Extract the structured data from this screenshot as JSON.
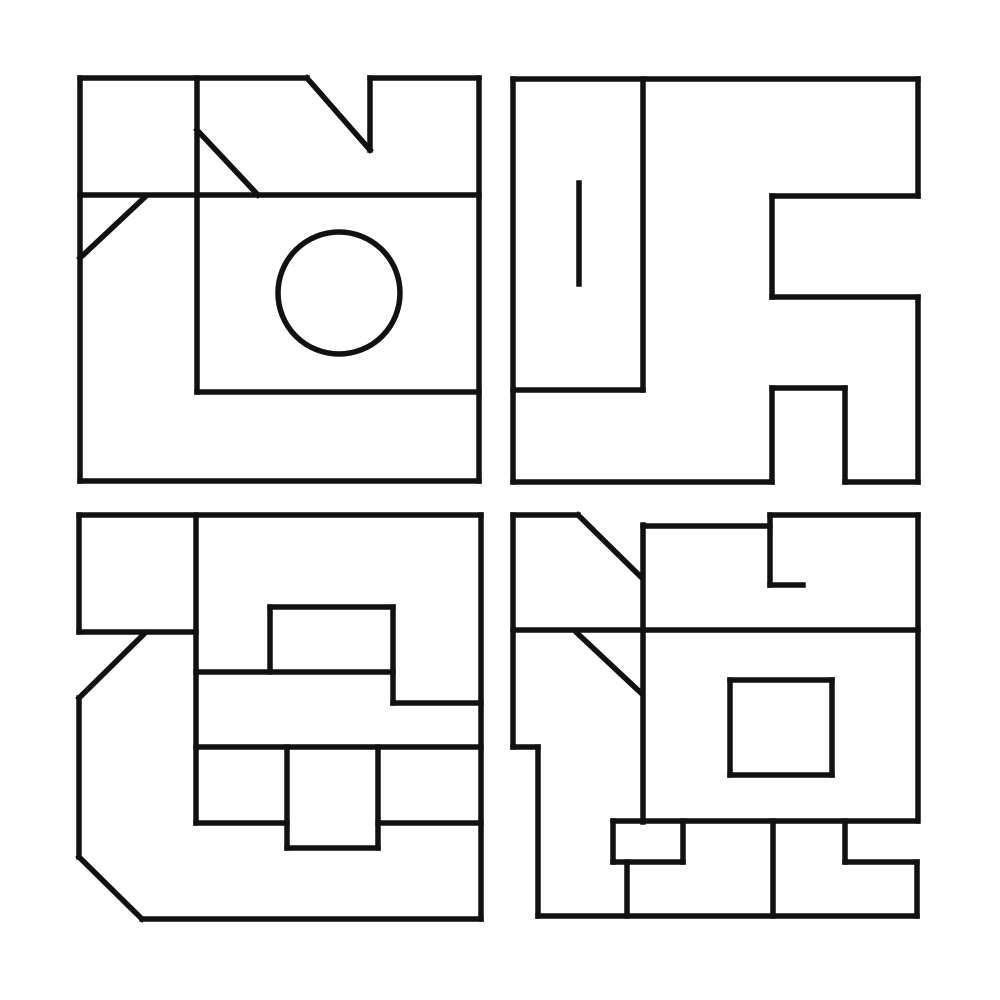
{
  "canvas": {
    "width": 1000,
    "height": 1000,
    "background_color": "#ffffff",
    "stroke_color": "#111111",
    "stroke_width": 5.5,
    "grid": "2x2 panels of abstract black line-art glyphs"
  },
  "panels": [
    {
      "name": "top-left-glyph",
      "bounds": [
        80,
        78,
        479,
        481
      ],
      "segments": [
        [
          80,
          78,
          307,
          78
        ],
        [
          370,
          78,
          479,
          78
        ],
        [
          479,
          78,
          479,
          481
        ],
        [
          80,
          481,
          479,
          481
        ],
        [
          80,
          78,
          80,
          481
        ],
        [
          307,
          78,
          370,
          150
        ],
        [
          370,
          78,
          370,
          150
        ],
        [
          197,
          78,
          197,
          392
        ],
        [
          80,
          195,
          479,
          195
        ],
        [
          197,
          130,
          258,
          195
        ],
        [
          145,
          197,
          80,
          258
        ],
        [
          197,
          392,
          479,
          392
        ]
      ],
      "circles": [
        {
          "cx": 339,
          "cy": 293,
          "r": 61
        }
      ]
    },
    {
      "name": "top-right-glyph",
      "bounds": [
        513,
        79,
        918,
        482
      ],
      "segments": [
        [
          513,
          79,
          918,
          79
        ],
        [
          513,
          79,
          513,
          482
        ],
        [
          513,
          482,
          772,
          482
        ],
        [
          845,
          482,
          918,
          482
        ],
        [
          918,
          79,
          918,
          196
        ],
        [
          918,
          297,
          918,
          482
        ],
        [
          772,
          196,
          918,
          196
        ],
        [
          772,
          196,
          772,
          297
        ],
        [
          772,
          297,
          918,
          297
        ],
        [
          772,
          388,
          772,
          482
        ],
        [
          772,
          388,
          845,
          388
        ],
        [
          845,
          388,
          845,
          482
        ],
        [
          643,
          79,
          643,
          390
        ],
        [
          513,
          390,
          643,
          390
        ],
        [
          579,
          183,
          579,
          284
        ]
      ],
      "circles": []
    },
    {
      "name": "bottom-left-glyph",
      "bounds": [
        79,
        515,
        481,
        919
      ],
      "segments": [
        [
          79,
          515,
          481,
          515
        ],
        [
          481,
          515,
          481,
          919
        ],
        [
          142,
          919,
          481,
          919
        ],
        [
          79,
          857,
          142,
          919
        ],
        [
          79,
          698,
          79,
          857
        ],
        [
          145,
          633,
          79,
          698
        ],
        [
          79,
          515,
          79,
          632
        ],
        [
          79,
          632,
          196,
          632
        ],
        [
          196,
          515,
          196,
          823
        ],
        [
          196,
          672,
          393,
          672
        ],
        [
          270,
          607,
          393,
          607
        ],
        [
          270,
          607,
          270,
          672
        ],
        [
          393,
          607,
          393,
          703
        ],
        [
          393,
          703,
          481,
          703
        ],
        [
          196,
          747,
          481,
          747
        ],
        [
          196,
          823,
          287,
          823
        ],
        [
          378,
          823,
          481,
          823
        ],
        [
          287,
          747,
          287,
          848
        ],
        [
          378,
          747,
          378,
          848
        ],
        [
          287,
          848,
          378,
          848
        ]
      ],
      "circles": []
    },
    {
      "name": "bottom-right-glyph",
      "bounds": [
        513,
        515,
        918,
        916
      ],
      "segments": [
        [
          513,
          515,
          578,
          515
        ],
        [
          578,
          515,
          641,
          577
        ],
        [
          643,
          525,
          643,
          822
        ],
        [
          643,
          526,
          770,
          526
        ],
        [
          770,
          515,
          770,
          585
        ],
        [
          770,
          585,
          803,
          585
        ],
        [
          770,
          515,
          918,
          515
        ],
        [
          918,
          515,
          918,
          821
        ],
        [
          513,
          630,
          918,
          630
        ],
        [
          577,
          633,
          641,
          693
        ],
        [
          513,
          515,
          513,
          747
        ],
        [
          513,
          747,
          538,
          747
        ],
        [
          538,
          747,
          538,
          916
        ],
        [
          538,
          916,
          917,
          916
        ],
        [
          730,
          680,
          832,
          680
        ],
        [
          832,
          680,
          832,
          775
        ],
        [
          730,
          775,
          832,
          775
        ],
        [
          730,
          680,
          730,
          775
        ],
        [
          613,
          821,
          917,
          821
        ],
        [
          613,
          821,
          613,
          862
        ],
        [
          613,
          862,
          683,
          862
        ],
        [
          683,
          821,
          683,
          862
        ],
        [
          627,
          862,
          627,
          916
        ],
        [
          773,
          821,
          773,
          916
        ],
        [
          845,
          821,
          845,
          862
        ],
        [
          845,
          862,
          917,
          862
        ],
        [
          917,
          862,
          917,
          916
        ]
      ],
      "circles": []
    }
  ]
}
